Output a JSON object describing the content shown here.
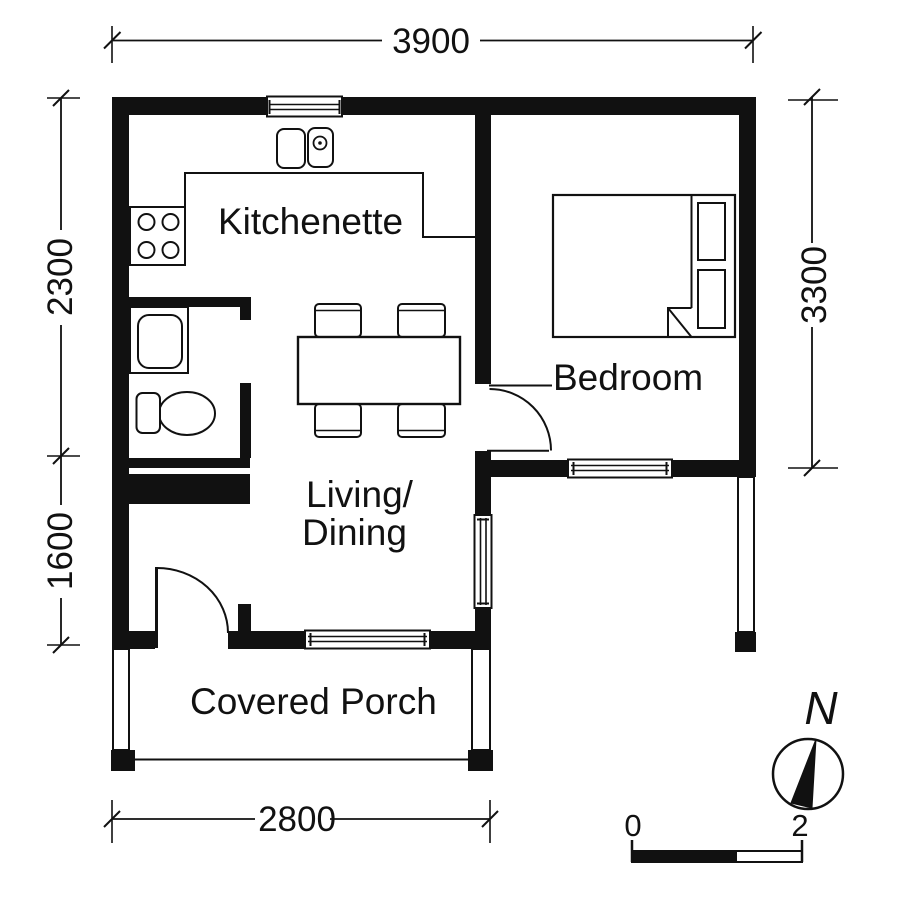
{
  "plan": {
    "title": "one-bedroom cottage floor plan",
    "rooms": [
      {
        "id": "kitchenette",
        "label": "Kitchenette"
      },
      {
        "id": "bedroom",
        "label": "Bedroom"
      },
      {
        "id": "living_dining",
        "label_line1": "Living/",
        "label_line2": "Dining"
      },
      {
        "id": "covered_porch",
        "label": "Covered Porch"
      }
    ],
    "dimensions": {
      "top": "3900",
      "left_upper": "2300",
      "left_lower": "1600",
      "right": "3300",
      "bottom": "2800"
    },
    "scale_bar": {
      "start_label": "0",
      "end_label": "2"
    },
    "compass": {
      "north_label": "N"
    },
    "fixtures": [
      "kitchen-sink",
      "stove",
      "kitchen-counter",
      "bathroom-sink",
      "toilet",
      "dining-table",
      "dining-chair",
      "bed",
      "pillow",
      "window",
      "door",
      "porch-post"
    ],
    "colors": {
      "ink": "#111111",
      "paper": "#ffffff"
    }
  }
}
